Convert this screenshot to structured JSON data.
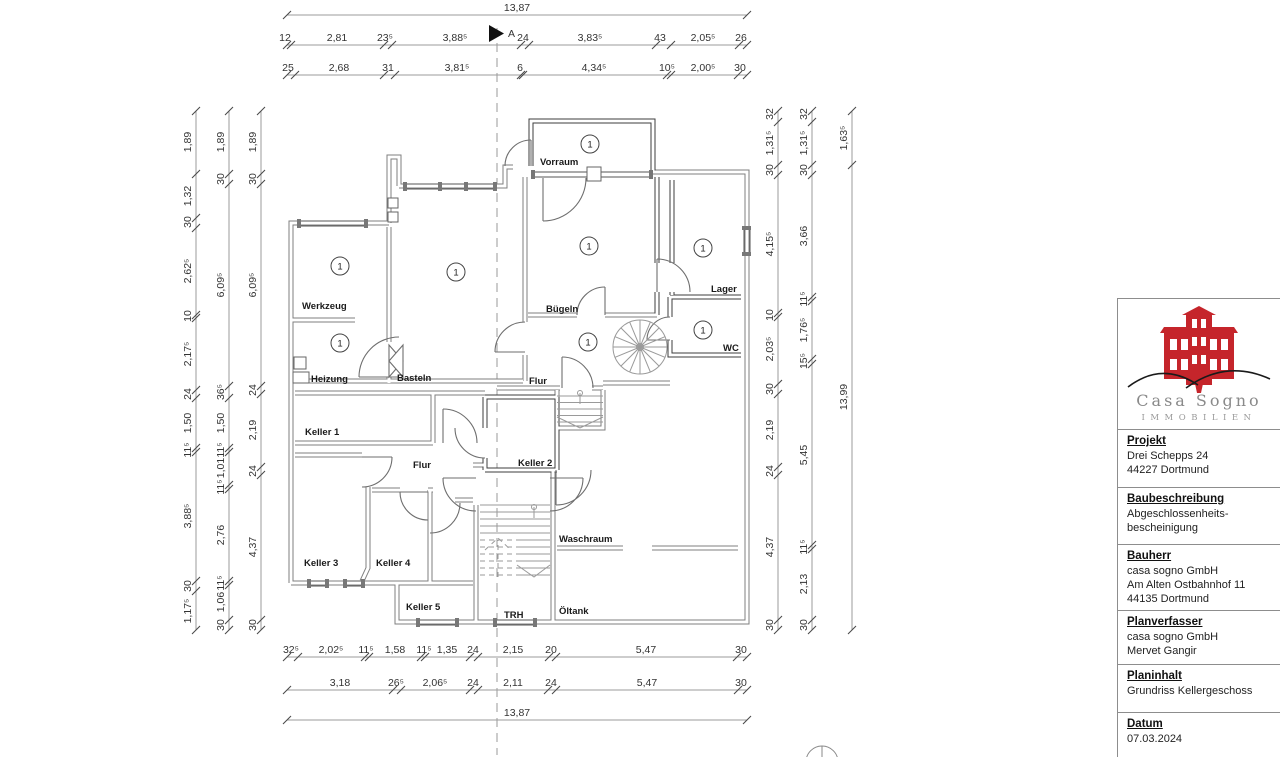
{
  "meta": {
    "section_marker": "A"
  },
  "titleblock": {
    "logo": {
      "brand": "Casa Sogno",
      "subtitle": "IMMOBILIEN",
      "color": "#c5252b",
      "text_color": "#8a8a8a"
    },
    "sections": [
      {
        "heading": "Projekt",
        "lines": [
          "Drei Schepps 24",
          "44227 Dortmund"
        ],
        "h": 58
      },
      {
        "heading": "Baubeschreibung",
        "lines": [
          "Abgeschlossenheits-",
          "bescheinigung"
        ],
        "h": 57
      },
      {
        "heading": "Bauherr",
        "lines": [
          "casa sogno GmbH",
          "Am Alten Ostbahnhof 11",
          "44135 Dortmund"
        ],
        "h": 62
      },
      {
        "heading": "Planverfasser",
        "lines": [
          "casa sogno GmbH",
          "Mervet Gangir"
        ],
        "h": 54
      },
      {
        "heading": "Planinhalt",
        "lines": [
          "Grundriss Kellergeschoss"
        ],
        "h": 48
      },
      {
        "heading": "Datum",
        "lines": [
          "07.03.2024"
        ],
        "h": 45
      }
    ]
  },
  "plan": {
    "unit_circle_text": "1",
    "unit_circles": [
      [
        590,
        144
      ],
      [
        589,
        246
      ],
      [
        703,
        248
      ],
      [
        703,
        330
      ],
      [
        588,
        342
      ],
      [
        340,
        266
      ],
      [
        340,
        343
      ],
      [
        456,
        272
      ]
    ],
    "rooms": [
      {
        "label": "Vorraum",
        "lx": 540,
        "ly": 165
      },
      {
        "label": "Bügeln",
        "lx": 546,
        "ly": 312
      },
      {
        "label": "Lager",
        "lx": 711,
        "ly": 292
      },
      {
        "label": "WC",
        "lx": 723,
        "ly": 351
      },
      {
        "label": "Flur",
        "lx": 529,
        "ly": 384
      },
      {
        "label": "Werkzeug",
        "lx": 302,
        "ly": 309
      },
      {
        "label": "Heizung",
        "lx": 311,
        "ly": 382
      },
      {
        "label": "Basteln",
        "lx": 397,
        "ly": 381
      },
      {
        "label": "Keller 1",
        "lx": 305,
        "ly": 435
      },
      {
        "label": "Keller 2",
        "lx": 518,
        "ly": 466
      },
      {
        "label": "Flur",
        "lx": 413,
        "ly": 468
      },
      {
        "label": "Keller 3",
        "lx": 304,
        "ly": 566
      },
      {
        "label": "Keller 4",
        "lx": 376,
        "ly": 566
      },
      {
        "label": "Keller 5",
        "lx": 406,
        "ly": 610
      },
      {
        "label": "TRH",
        "lx": 504,
        "ly": 618
      },
      {
        "label": "Waschraum",
        "lx": 559,
        "ly": 542
      },
      {
        "label": "Öltank",
        "lx": 559,
        "ly": 614
      }
    ],
    "chains": [
      {
        "id": "top-overall",
        "axis": "x",
        "line": 15,
        "from": 287,
        "to": 747,
        "ticks": [
          287,
          747
        ],
        "labels": [
          {
            "t": "13,87",
            "c": 517
          }
        ]
      },
      {
        "id": "top-row2",
        "axis": "x",
        "line": 45,
        "from": 287,
        "to": 747,
        "ticks": [
          287,
          291,
          384,
          392,
          521,
          529,
          656,
          671,
          739,
          747
        ],
        "labels": [
          {
            "t": "12",
            "c": 285
          },
          {
            "t": "2,81",
            "c": 337
          },
          {
            "t": "23⁵",
            "c": 385
          },
          {
            "t": "3,88⁵",
            "c": 455
          },
          {
            "t": "24",
            "c": 523
          },
          {
            "t": "3,83⁵",
            "c": 590
          },
          {
            "t": "43",
            "c": 660
          },
          {
            "t": "2,05⁵",
            "c": 703
          },
          {
            "t": "26",
            "c": 741
          }
        ]
      },
      {
        "id": "top-row3",
        "axis": "x",
        "line": 75,
        "from": 287,
        "to": 747,
        "ticks": [
          287,
          295,
          384,
          395,
          521,
          523,
          667,
          671,
          738,
          747
        ],
        "labels": [
          {
            "t": "25",
            "c": 288
          },
          {
            "t": "2,68",
            "c": 339
          },
          {
            "t": "31",
            "c": 388
          },
          {
            "t": "3,81⁵",
            "c": 457
          },
          {
            "t": "6",
            "c": 520
          },
          {
            "t": "4,34⁵",
            "c": 594
          },
          {
            "t": "10⁵",
            "c": 667
          },
          {
            "t": "2,00⁵",
            "c": 703
          },
          {
            "t": "30",
            "c": 740
          }
        ]
      },
      {
        "id": "bottom-row1",
        "axis": "x",
        "line": 657,
        "from": 287,
        "to": 747,
        "ticks": [
          287,
          298,
          365,
          369,
          421,
          425,
          470,
          478,
          549,
          556,
          737,
          747
        ],
        "labels": [
          {
            "t": "32⁵",
            "c": 291
          },
          {
            "t": "2,02⁵",
            "c": 331
          },
          {
            "t": "11⁵",
            "c": 366
          },
          {
            "t": "1,58",
            "c": 395
          },
          {
            "t": "11⁵",
            "c": 424
          },
          {
            "t": "1,35",
            "c": 447
          },
          {
            "t": "24",
            "c": 473
          },
          {
            "t": "2,15",
            "c": 513
          },
          {
            "t": "20",
            "c": 551
          },
          {
            "t": "5,47",
            "c": 646
          },
          {
            "t": "30",
            "c": 741
          }
        ]
      },
      {
        "id": "bottom-row2",
        "axis": "x",
        "line": 690,
        "from": 287,
        "to": 747,
        "ticks": [
          287,
          393,
          401,
          470,
          478,
          548,
          556,
          738,
          747
        ],
        "labels": [
          {
            "t": "3,18",
            "c": 340
          },
          {
            "t": "26⁵",
            "c": 396
          },
          {
            "t": "2,06⁵",
            "c": 435
          },
          {
            "t": "24",
            "c": 473
          },
          {
            "t": "2,11",
            "c": 513
          },
          {
            "t": "24",
            "c": 551
          },
          {
            "t": "5,47",
            "c": 647
          },
          {
            "t": "30",
            "c": 741
          }
        ]
      },
      {
        "id": "bottom-overall",
        "axis": "x",
        "line": 720,
        "from": 287,
        "to": 747,
        "ticks": [
          287,
          747
        ],
        "labels": [
          {
            "t": "13,87",
            "c": 517
          }
        ]
      },
      {
        "id": "left-col1",
        "axis": "y",
        "line": 196,
        "from": 111,
        "to": 630,
        "ticks": [
          111,
          174,
          218,
          228,
          315,
          318,
          390,
          398,
          448,
          452,
          581,
          591,
          630
        ],
        "labels": [
          {
            "t": "1,89",
            "c": 142
          },
          {
            "t": "1,32",
            "c": 196
          },
          {
            "t": "30",
            "c": 222
          },
          {
            "t": "2,62⁵",
            "c": 271
          },
          {
            "t": "10",
            "c": 316
          },
          {
            "t": "2,17⁵",
            "c": 354
          },
          {
            "t": "24",
            "c": 394
          },
          {
            "t": "1,50",
            "c": 423
          },
          {
            "t": "11⁵",
            "c": 450
          },
          {
            "t": "3,88⁵",
            "c": 516
          },
          {
            "t": "30",
            "c": 586
          },
          {
            "t": "1,17⁵",
            "c": 611
          }
        ]
      },
      {
        "id": "left-col2",
        "axis": "y",
        "line": 229,
        "from": 111,
        "to": 630,
        "ticks": [
          111,
          174,
          184,
          386,
          398,
          448,
          452,
          485,
          489,
          581,
          585,
          620,
          630
        ],
        "labels": [
          {
            "t": "1,89",
            "c": 142
          },
          {
            "t": "30",
            "c": 179
          },
          {
            "t": "6,09⁵",
            "c": 285
          },
          {
            "t": "36⁵",
            "c": 392
          },
          {
            "t": "1,50",
            "c": 423
          },
          {
            "t": "11⁵",
            "c": 450
          },
          {
            "t": "1,01",
            "c": 468
          },
          {
            "t": "11⁵",
            "c": 487
          },
          {
            "t": "2,76",
            "c": 535
          },
          {
            "t": "11⁵",
            "c": 583
          },
          {
            "t": "1,06",
            "c": 602
          },
          {
            "t": "30",
            "c": 625
          }
        ]
      },
      {
        "id": "left-col3",
        "axis": "y",
        "line": 261,
        "from": 111,
        "to": 630,
        "ticks": [
          111,
          174,
          184,
          386,
          394,
          467,
          475,
          620,
          630
        ],
        "labels": [
          {
            "t": "1,89",
            "c": 142
          },
          {
            "t": "30",
            "c": 179
          },
          {
            "t": "6,09⁵",
            "c": 285
          },
          {
            "t": "24",
            "c": 390
          },
          {
            "t": "2,19",
            "c": 430
          },
          {
            "t": "24",
            "c": 471
          },
          {
            "t": "4,37",
            "c": 547
          },
          {
            "t": "30",
            "c": 625
          }
        ]
      },
      {
        "id": "right-col1",
        "axis": "y",
        "line": 778,
        "from": 111,
        "to": 630,
        "ticks": [
          111,
          122,
          165,
          175,
          313,
          317,
          384,
          394,
          467,
          475,
          620,
          630
        ],
        "labels": [
          {
            "t": "32",
            "c": 114
          },
          {
            "t": "1,31⁵",
            "c": 143
          },
          {
            "t": "30",
            "c": 170
          },
          {
            "t": "4,15⁵",
            "c": 244
          },
          {
            "t": "10",
            "c": 315
          },
          {
            "t": "2,03⁵",
            "c": 349
          },
          {
            "t": "30",
            "c": 389
          },
          {
            "t": "2,19",
            "c": 430
          },
          {
            "t": "24",
            "c": 471
          },
          {
            "t": "4,37",
            "c": 547
          },
          {
            "t": "30",
            "c": 625
          }
        ]
      },
      {
        "id": "right-col2",
        "axis": "y",
        "line": 812,
        "from": 111,
        "to": 630,
        "ticks": [
          111,
          122,
          165,
          175,
          297,
          301,
          359,
          364,
          545,
          549,
          620,
          630
        ],
        "labels": [
          {
            "t": "32",
            "c": 114
          },
          {
            "t": "1,31⁵",
            "c": 143
          },
          {
            "t": "30",
            "c": 170
          },
          {
            "t": "3,66",
            "c": 236
          },
          {
            "t": "11⁵",
            "c": 299
          },
          {
            "t": "1,76⁵",
            "c": 330
          },
          {
            "t": "15⁵",
            "c": 361
          },
          {
            "t": "5,45",
            "c": 455
          },
          {
            "t": "11⁵",
            "c": 547
          },
          {
            "t": "2,13",
            "c": 584
          },
          {
            "t": "30",
            "c": 625
          }
        ]
      },
      {
        "id": "right-col3",
        "axis": "y",
        "line": 852,
        "from": 111,
        "to": 630,
        "ticks": [
          111,
          165,
          630
        ],
        "labels": [
          {
            "t": "1,63⁵",
            "c": 138
          },
          {
            "t": "13,99",
            "c": 397
          }
        ]
      }
    ]
  }
}
